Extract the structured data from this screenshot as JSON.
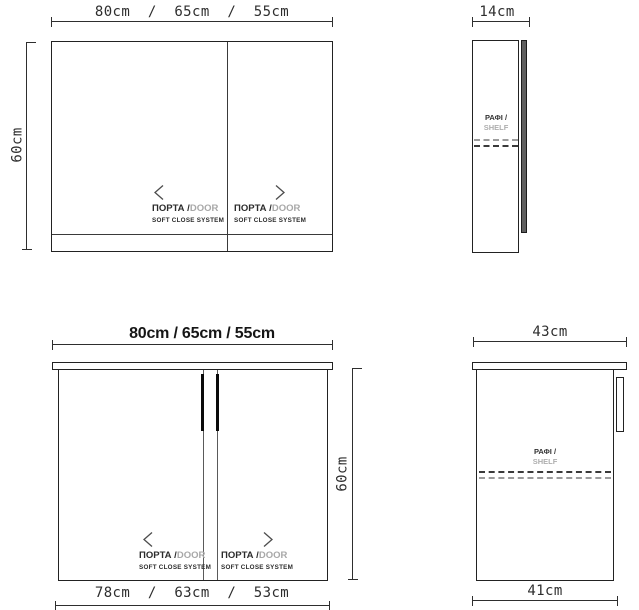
{
  "sheet": {
    "title": "cabinet-technical-drawing",
    "colors": {
      "line": "#2e2e2e",
      "gray_text": "#a8a8a8",
      "dark_text": "#2b2b2b"
    }
  },
  "wall_front": {
    "width_label": "80cm  /  65cm  /  55cm",
    "height_label": "60cm",
    "doors": [
      {
        "gr": "ΠΟΡΤΑ /",
        "en": "DOOR",
        "sub": "SOFT CLOSE SYSTEM",
        "chevron": "left"
      },
      {
        "gr": "ΠΟΡΤΑ /",
        "en": "DOOR",
        "sub": "SOFT CLOSE SYSTEM",
        "chevron": "right"
      }
    ]
  },
  "wall_side": {
    "depth_label": "14cm",
    "shelf_gr": "ΡΑΦΙ /",
    "shelf_en": "SHELF"
  },
  "base_front": {
    "width_label": "80cm / 65cm / 55cm",
    "height_label": "60cm",
    "carcass_width_label": "78cm  /  63cm  /  53cm",
    "doors": [
      {
        "gr": "ΠΟΡΤΑ /",
        "en": "DOOR",
        "sub": "SOFT CLOSE SYSTEM",
        "chevron": "left"
      },
      {
        "gr": "ΠΟΡΤΑ /",
        "en": "DOOR",
        "sub": "SOFT CLOSE SYSTEM",
        "chevron": "right"
      }
    ]
  },
  "base_side": {
    "top_depth_label": "43cm",
    "bottom_depth_label": "41cm",
    "shelf_gr": "ΡΑΦΙ /",
    "shelf_en": "SHELF"
  }
}
